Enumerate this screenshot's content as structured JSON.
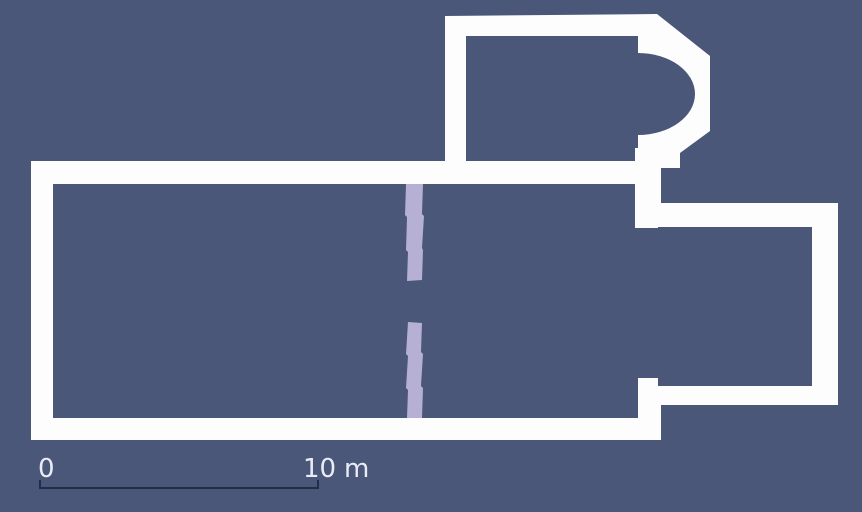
{
  "figure": {
    "kind": "architectural-floor-plan",
    "background_color": "#4a5778",
    "wall_color": "#fdfdfe",
    "partition_color": "#b7b0d5"
  },
  "scale_bar": {
    "start_label": "0",
    "end_label": "10",
    "unit_label": "m",
    "line_color": "#232d47",
    "text_color": "#e9ecf5"
  }
}
